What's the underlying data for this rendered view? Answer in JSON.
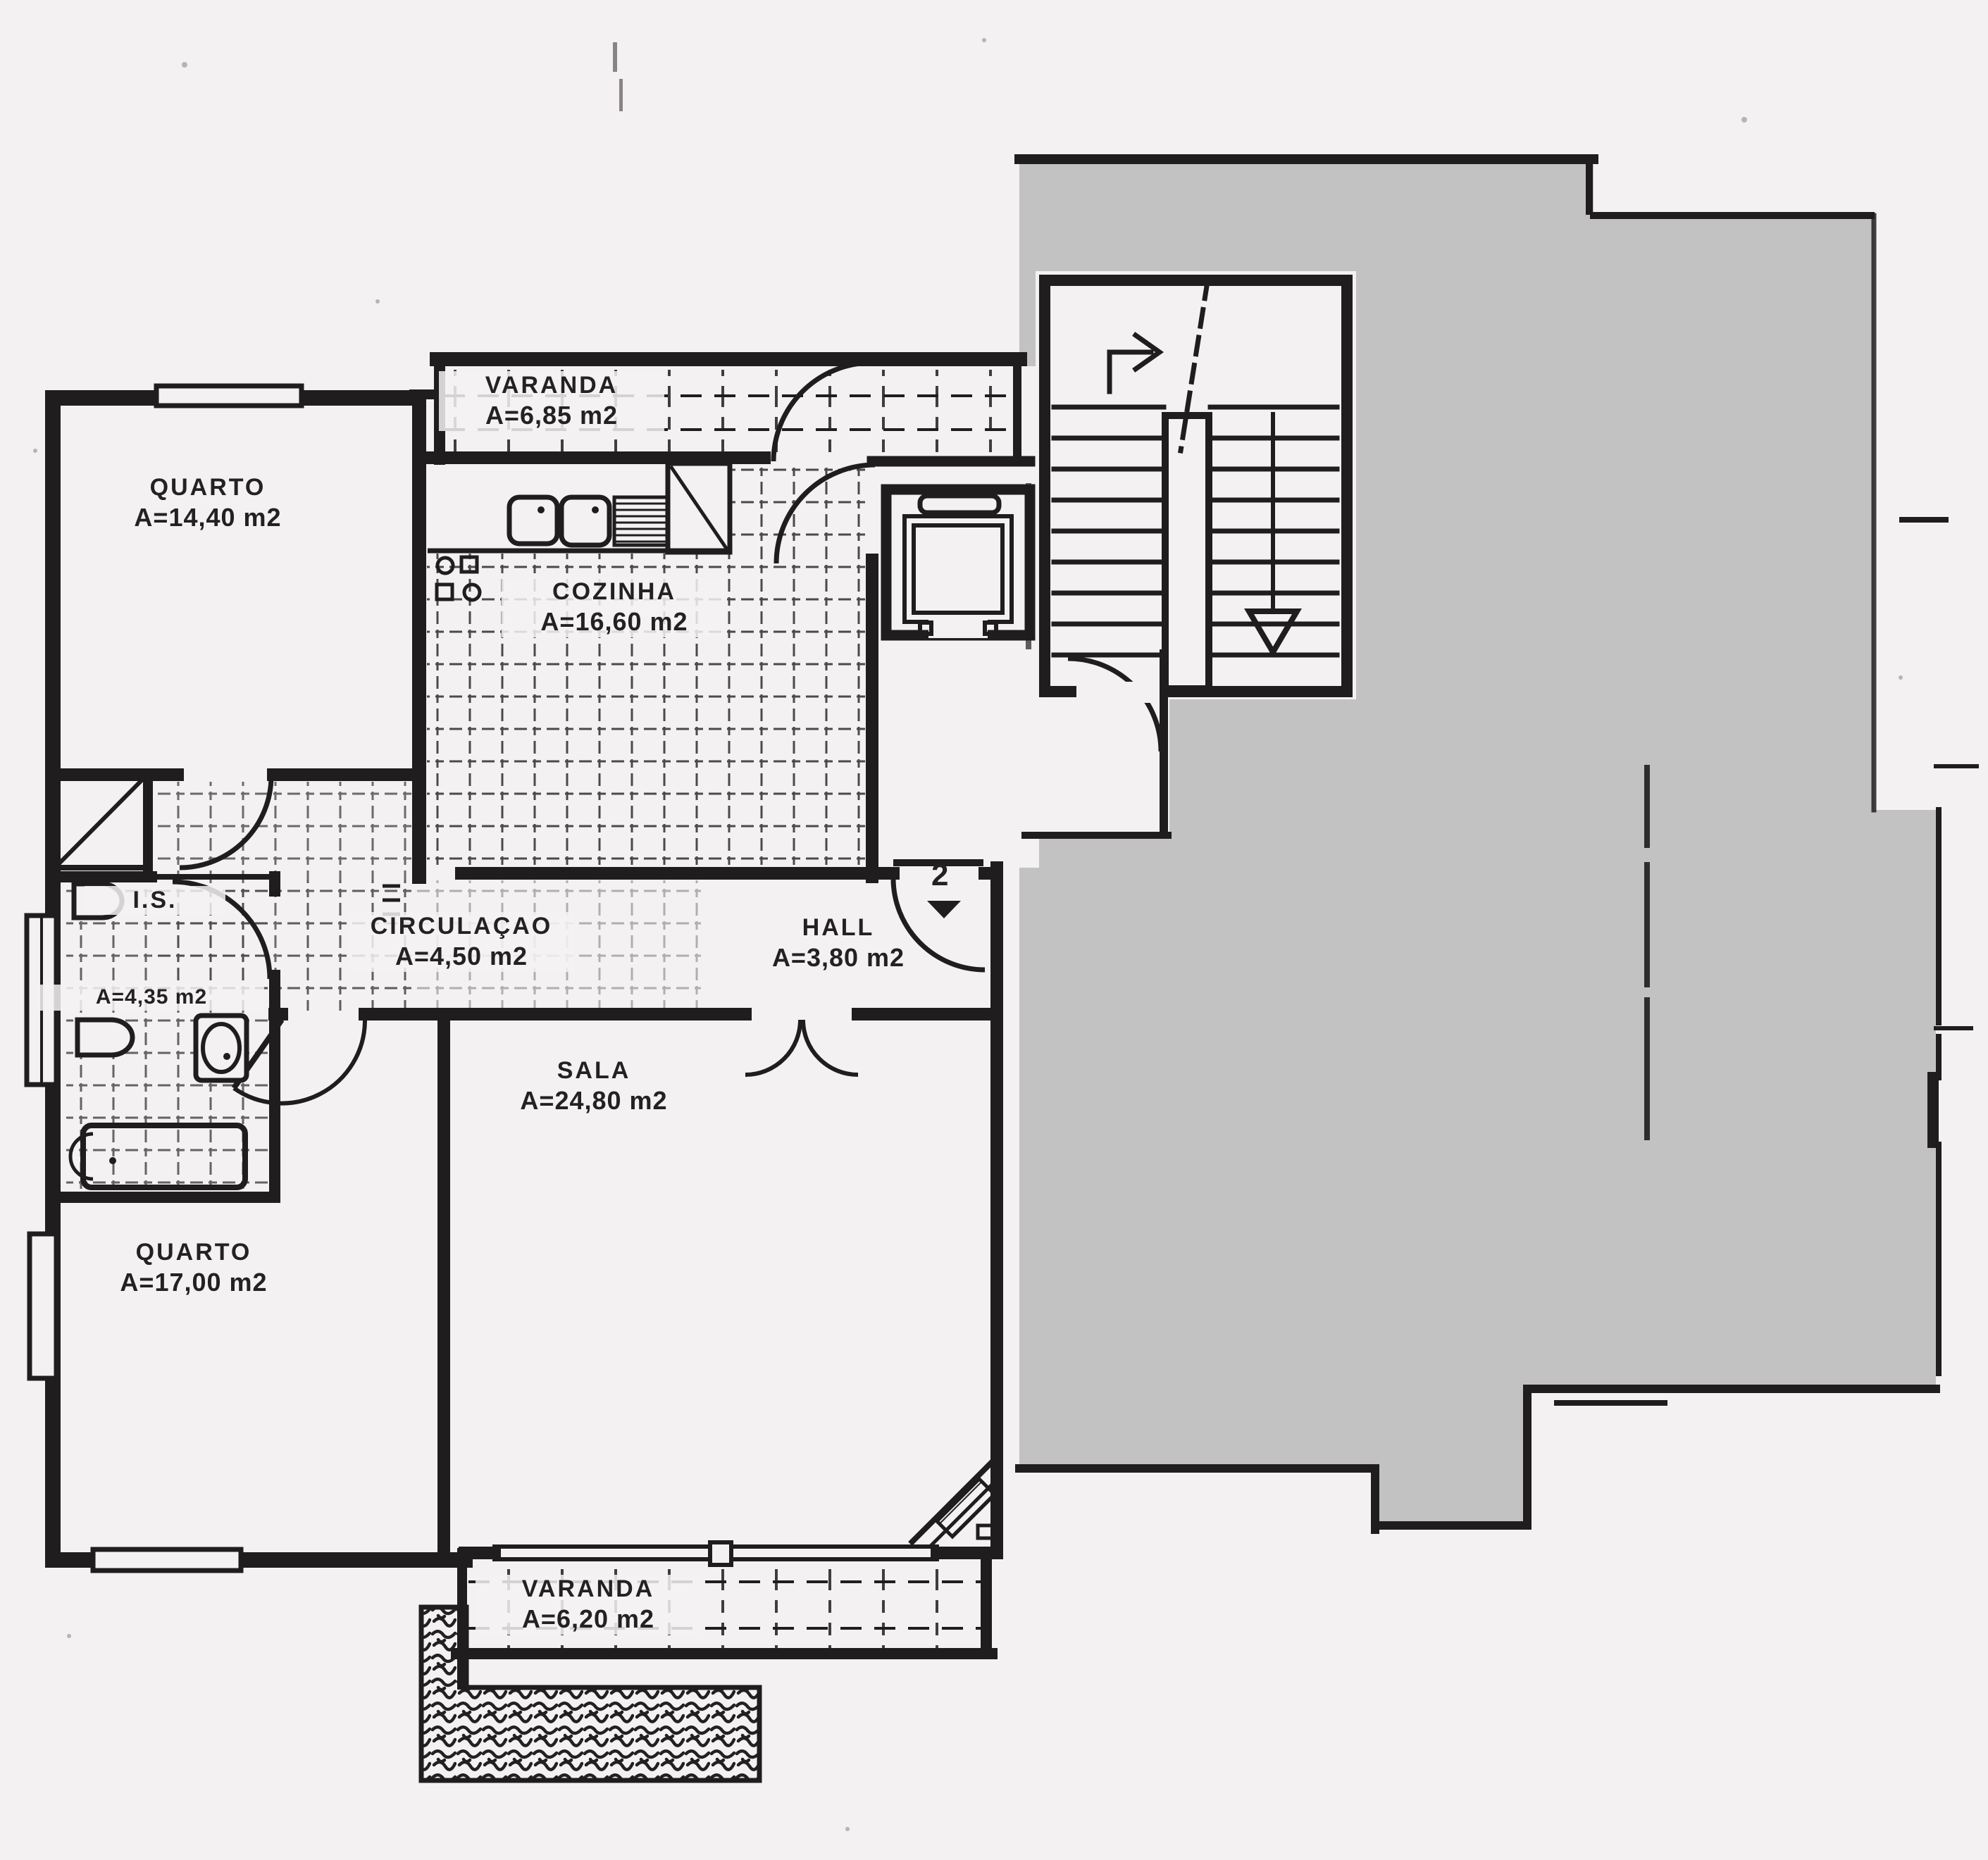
{
  "plan": {
    "document_type": "apartment-floor-plan (scanned)",
    "language": "pt",
    "colors": {
      "paper": "#f4f1f2",
      "ink": "#201d1e",
      "mask_gray": "#c2c2c2"
    },
    "rooms": [
      {
        "id": "quarto-1",
        "name": "QUARTO",
        "area": "A=14,40 m2"
      },
      {
        "id": "varanda-1",
        "name": "VARANDA",
        "area": "A=6,85 m2"
      },
      {
        "id": "cozinha",
        "name": "COZINHA",
        "area": "A=16,60 m2"
      },
      {
        "id": "circulacao",
        "name": "CIRCULAÇAO",
        "area": "A=4,50 m2"
      },
      {
        "id": "hall",
        "name": "HALL",
        "area": "A=3,80 m2"
      },
      {
        "id": "is",
        "name": "I.S.",
        "area": "A=4,35 m2"
      },
      {
        "id": "sala",
        "name": "SALA",
        "area": "A=24,80 m2"
      },
      {
        "id": "quarto-2",
        "name": "QUARTO",
        "area": "A=17,00 m2"
      },
      {
        "id": "varanda-2",
        "name": "VARANDA",
        "area": "A=6,20 m2"
      }
    ],
    "entrance": {
      "apartment_number": "2"
    }
  }
}
